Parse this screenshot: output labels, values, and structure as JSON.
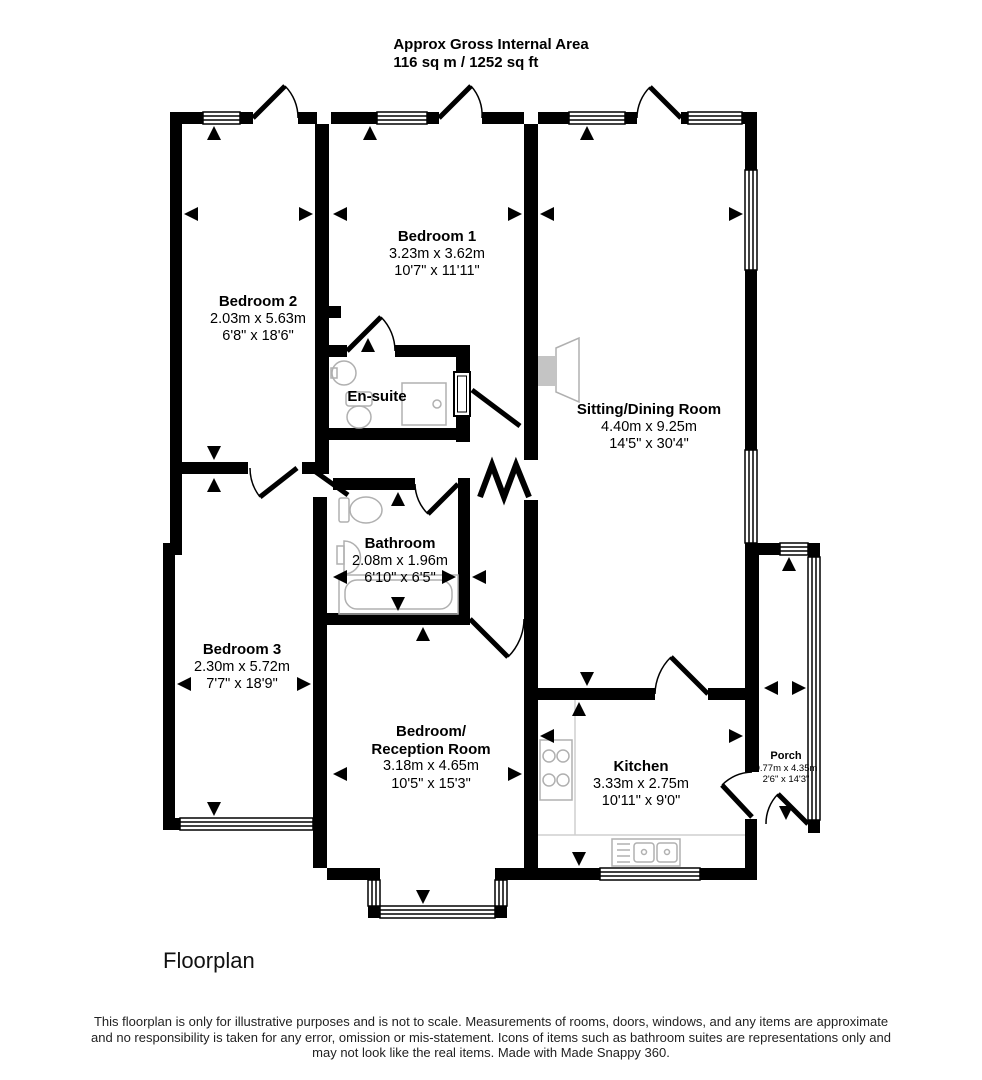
{
  "title": {
    "line1": "Approx Gross Internal Area",
    "line2": "116 sq m / 1252 sq ft"
  },
  "rooms": {
    "bedroom1": {
      "name": "Bedroom 1",
      "metric": "3.23m x 3.62m",
      "imperial": "10'7\" x 11'11\""
    },
    "bedroom2": {
      "name": "Bedroom 2",
      "metric": "2.03m x 5.63m",
      "imperial": "6'8\" x 18'6\""
    },
    "ensuite": {
      "name": "En-suite"
    },
    "sitting": {
      "name": "Sitting/Dining Room",
      "metric": "4.40m x 9.25m",
      "imperial": "14'5\" x 30'4\""
    },
    "bathroom": {
      "name": "Bathroom",
      "metric": "2.08m x 1.96m",
      "imperial": "6'10\" x 6'5\""
    },
    "bedroom3": {
      "name": "Bedroom 3",
      "metric": "2.30m x 5.72m",
      "imperial": "7'7\" x 18'9\""
    },
    "bedroom_reception": {
      "name1": "Bedroom/",
      "name2": "Reception Room",
      "metric": "3.18m x 4.65m",
      "imperial": "10'5\" x 15'3\""
    },
    "kitchen": {
      "name": "Kitchen",
      "metric": "3.33m x 2.75m",
      "imperial": "10'11\" x 9'0\""
    },
    "porch": {
      "name": "Porch",
      "metric": "0.77m x 4.35m",
      "imperial": "2'6\" x 14'3\""
    }
  },
  "caption": "Floorplan",
  "footer": {
    "line1": "This floorplan is only for illustrative purposes and is not to scale. Measurements of rooms, doors, windows, and any items are approximate",
    "line2": "and no responsibility is taken for any error, omission or mis-statement. Icons of items such as bathroom suites are representations only and",
    "line3": "may not look like the real items. Made with Made Snappy 360."
  },
  "colors": {
    "wall": "#000000",
    "fixture": "#b0b0b0",
    "fireplace_fill": "#c4c4c4"
  }
}
